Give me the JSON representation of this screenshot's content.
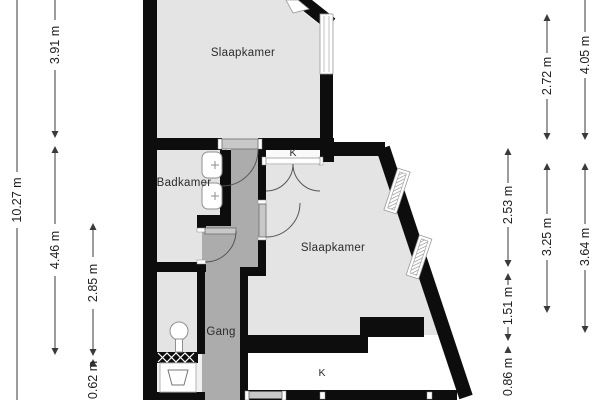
{
  "plan_labels": {
    "slaapkamer_top": "Slaapkamer",
    "badkamer": "Badkamer",
    "slaapkamer_right": "Slaapkamer",
    "gang": "Gang",
    "closet_top": "K",
    "closet_bottom": "K"
  },
  "dimensions_left": {
    "total": "10.27 m",
    "top": "3.91 m",
    "middle": "4.46 m",
    "inner_middle": "2.85 m",
    "inner_bottom": "0.62 m"
  },
  "dimensions_right": {
    "inner_top": "2.53 m",
    "inner_middle": "1.51 m",
    "inner_bottom": "0.86 m",
    "middle_top": "2.72 m",
    "middle_bottom": "3.25 m",
    "outer_top": "4.05 m",
    "outer_bottom": "3.64 m"
  },
  "colors": {
    "wall": "#0d0d0d",
    "room_floor": "#e4e4e4",
    "hallway_floor": "#acacac",
    "closet_floor": "#ffffff",
    "outside": "#ffffff",
    "dimension_text": "#1e1e1e"
  }
}
